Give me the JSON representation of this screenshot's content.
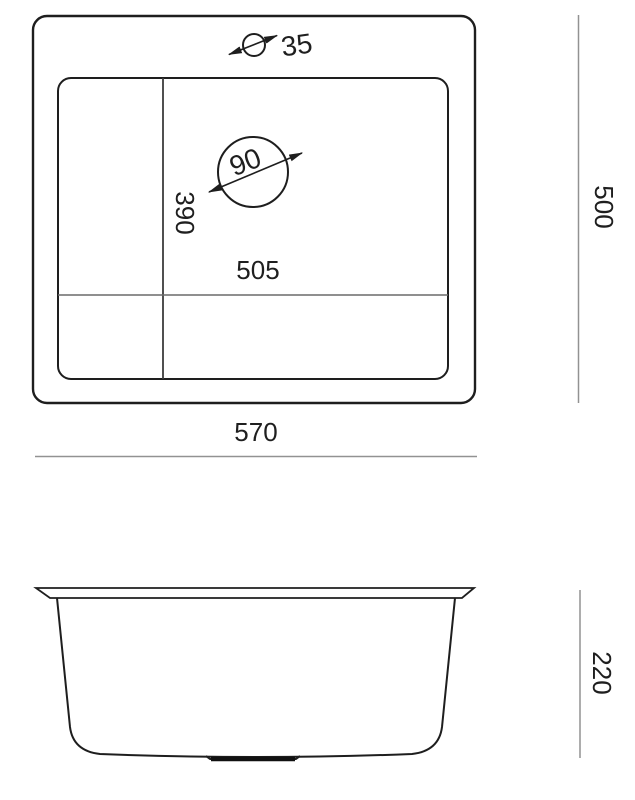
{
  "title": "Sink technical dimension drawing",
  "colors": {
    "background": "#ffffff",
    "outline": "#1e1e1e",
    "interior_line": "#6a6a6a",
    "dimension_line": "#929292",
    "text": "#1f1f1f"
  },
  "views": {
    "top": {
      "faucet_hole_diameter": "35",
      "drain_diameter": "90",
      "bowl_depth": "390",
      "bowl_width": "505",
      "overall_width": "570",
      "overall_depth": "500"
    },
    "side": {
      "height": "220"
    }
  }
}
